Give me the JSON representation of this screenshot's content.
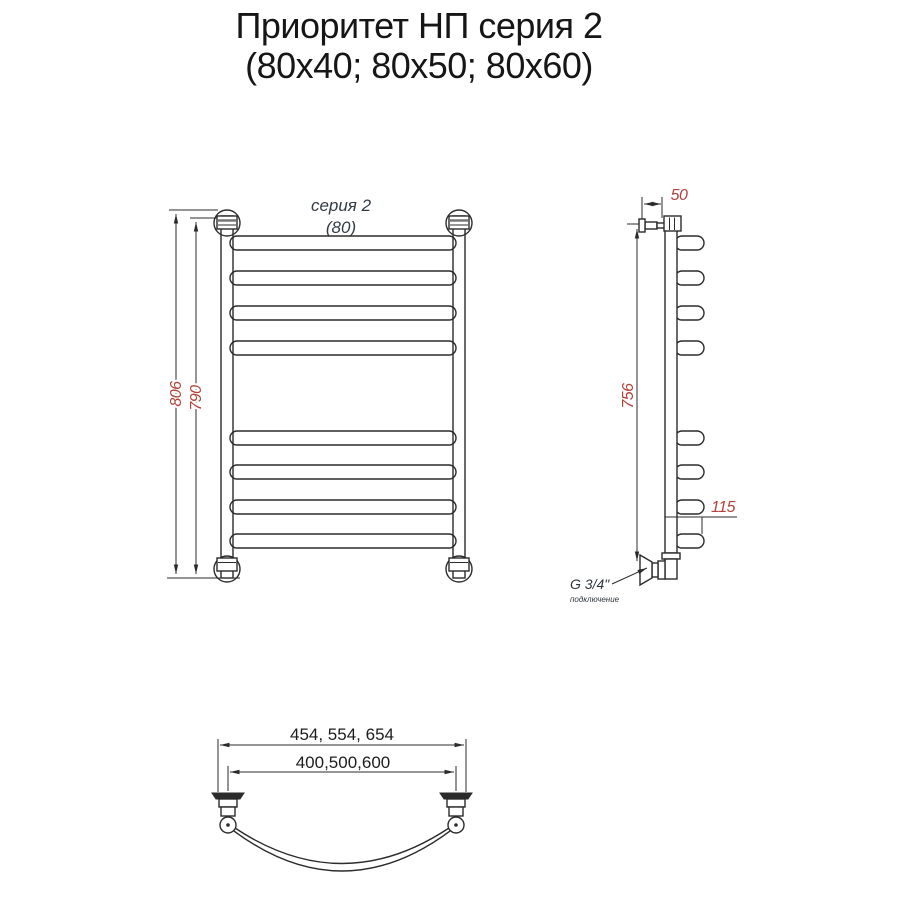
{
  "title": {
    "line1": "Приоритет НП серия 2",
    "line2": "(80x40; 80x50; 80x60)"
  },
  "front_view": {
    "series_label": "серия 2",
    "width_label": "(80)",
    "dim_outer_height_mm": "806",
    "dim_inner_height_mm": "790"
  },
  "side_view": {
    "dim_wall_offset_mm": "50",
    "dim_height_mm": "756",
    "dim_bottom_mm": "115",
    "connection_thread": "G 3/4\"",
    "connection_label": "подключение"
  },
  "bottom_view": {
    "dim_outer_widths_mm": "454, 554, 654",
    "dim_center_widths_mm": "400,500,600"
  },
  "colors": {
    "line": "#2b2b2b",
    "dimension_text": "#b2423a",
    "label_text": "#333b44",
    "title_text": "#161616",
    "background": "#ffffff"
  }
}
